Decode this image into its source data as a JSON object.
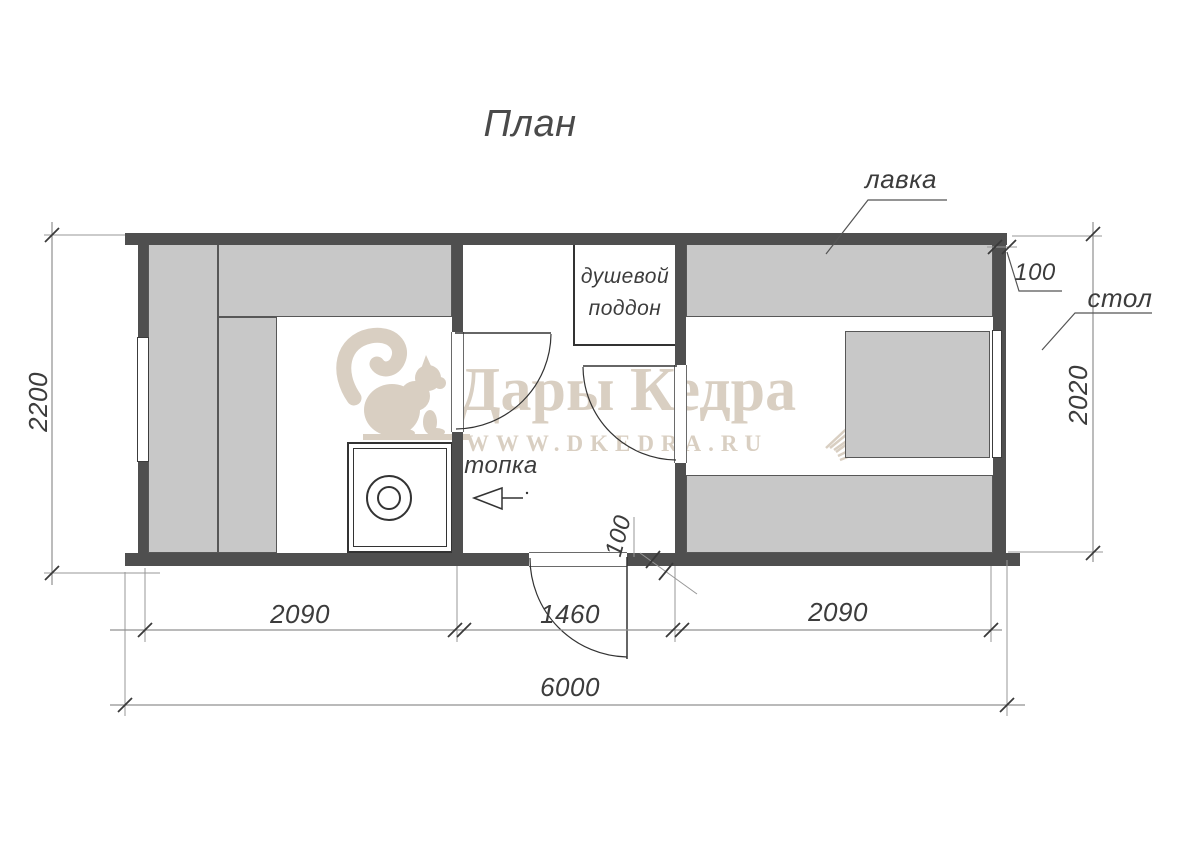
{
  "title": "План",
  "labels": {
    "bench": "лавка",
    "table": "стол",
    "firebox": "топка",
    "shower_line1": "душевой",
    "shower_line2": "поддон"
  },
  "dimensions": {
    "total_width": "6000",
    "left_room_width": "2090",
    "middle_room_width": "1460",
    "right_room_width": "2090",
    "left_height": "2200",
    "right_height": "2020",
    "wall_top_right": "100",
    "wall_bottom_middle": "100"
  },
  "watermark": {
    "brand": "Дары Кедра",
    "url": "WWW.DKEDRA.RU"
  },
  "colors": {
    "wall": "#4f4f4f",
    "bench_fill": "#c8c8c8",
    "outline": "#3c3c3c",
    "dim_line": "#909090",
    "watermark": "#d9cfc2",
    "background": "#ffffff"
  }
}
